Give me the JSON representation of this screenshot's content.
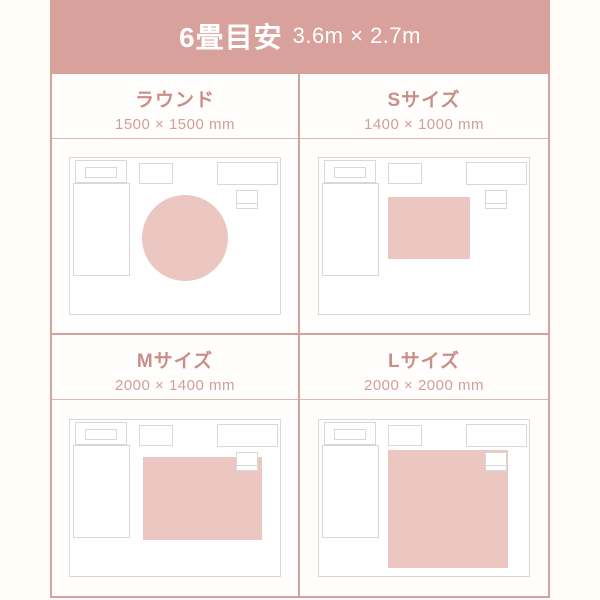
{
  "colors": {
    "bg": "#FFFCF8",
    "cellbg": "#FFFEFC",
    "salmon": "#D9A19B",
    "line": "#D5A39D",
    "lineThin": "#DEB7B1",
    "labelTitle": "#CA8E88",
    "labelSize": "#D39E98",
    "outline": "#D8D8D8",
    "rug": "#ECC6C1"
  },
  "header": {
    "title": "6畳目安",
    "dimensions": "3.6m × 2.7m"
  },
  "cells": [
    {
      "id": "round",
      "label": "ラウンド",
      "size": "1500 × 1500 mm",
      "rug": {
        "shape": "circle",
        "left": 72,
        "top": 37,
        "width": 86,
        "height": 86
      }
    },
    {
      "id": "s",
      "label": "Sサイズ",
      "size": "1400 × 1000 mm",
      "rug": {
        "shape": "rect",
        "left": 69,
        "top": 39,
        "width": 82,
        "height": 62
      }
    },
    {
      "id": "m",
      "label": "Mサイズ",
      "size": "2000 × 1400 mm",
      "rug": {
        "shape": "rect",
        "left": 73,
        "top": 37,
        "width": 119,
        "height": 83
      }
    },
    {
      "id": "l",
      "label": "Lサイズ",
      "size": "2000 × 2000 mm",
      "rug": {
        "shape": "rect",
        "left": 69,
        "top": 30,
        "width": 120,
        "height": 118
      }
    }
  ]
}
